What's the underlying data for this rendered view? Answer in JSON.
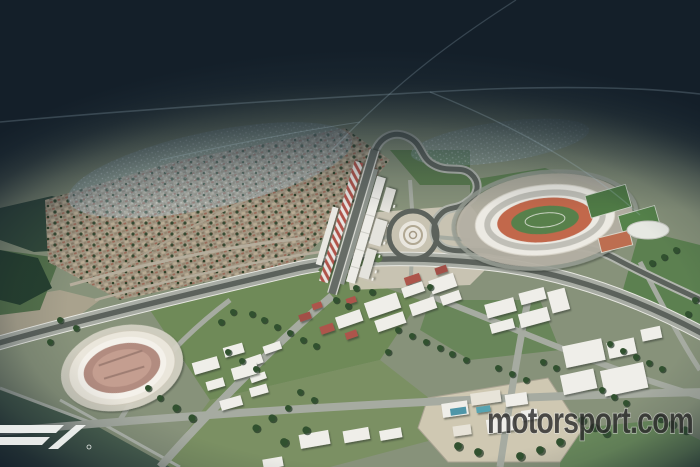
{
  "meta": {
    "description": "Aerial 3D rendering of the Hanoi Formula 1 street circuit at dusk: an illuminated circuit area with pit straight, roundabout plaza and national stadium, surrounded by a town, fields and warehouses, fading into dark fog toward the horizon."
  },
  "watermarks": {
    "motorsport": "motorsport.com",
    "f1_logo_name": "f1-logo"
  },
  "palette": {
    "fog_dark": "#16222c",
    "ground": "#87927a",
    "field_green": "#6f8a58",
    "road_light": "#a8aca4",
    "track_dark": "#5c625c",
    "building_white": "#efeee9",
    "roof_red": "#ad544b",
    "grandstand_red": "#b0524a",
    "stadium_track_orange": "#c2684c",
    "stadium_infield_green": "#58804b",
    "pool_blue": "#4f96a8",
    "lake_green": "#30483a",
    "shimmer_blue": "#9fb6c6"
  },
  "scene": {
    "labels": [
      "night-fog horizon",
      "residential town",
      "lake",
      "pit straight and paddock",
      "red-white grandstand",
      "roundabout plaza",
      "national stadium",
      "sports pitches",
      "aquatic dome",
      "warehouse district",
      "swimming-pool compound",
      "small oval arena",
      "sweeping highway",
      "race track"
    ],
    "trees": [
      [
        252,
        314
      ],
      [
        264,
        320
      ],
      [
        277,
        327
      ],
      [
        290,
        333
      ],
      [
        303,
        340
      ],
      [
        316,
        346
      ],
      [
        228,
        352
      ],
      [
        242,
        361
      ],
      [
        256,
        369
      ],
      [
        233,
        312
      ],
      [
        221,
        322
      ],
      [
        336,
        300
      ],
      [
        348,
        306
      ],
      [
        300,
        392
      ],
      [
        314,
        400
      ],
      [
        288,
        408
      ],
      [
        272,
        418,
        1.2
      ],
      [
        256,
        428,
        1.2
      ],
      [
        398,
        330
      ],
      [
        412,
        336
      ],
      [
        426,
        342
      ],
      [
        440,
        348
      ],
      [
        388,
        352
      ],
      [
        452,
        354
      ],
      [
        466,
        360
      ],
      [
        498,
        368
      ],
      [
        512,
        374
      ],
      [
        526,
        380
      ],
      [
        543,
        362
      ],
      [
        556,
        368
      ],
      [
        610,
        344
      ],
      [
        623,
        351
      ],
      [
        636,
        357
      ],
      [
        649,
        363
      ],
      [
        662,
        369
      ],
      [
        602,
        390
      ],
      [
        614,
        397
      ],
      [
        626,
        403
      ],
      [
        582,
        420,
        1.2
      ],
      [
        594,
        427,
        1.2
      ],
      [
        606,
        433,
        1.2
      ],
      [
        660,
        418,
        1.2
      ],
      [
        672,
        424,
        1.2
      ],
      [
        685,
        430,
        1.2
      ],
      [
        560,
        442,
        1.3
      ],
      [
        540,
        450,
        1.3
      ],
      [
        520,
        456,
        1.3
      ],
      [
        478,
        452,
        1.3
      ],
      [
        458,
        446,
        1.3
      ],
      [
        430,
        287
      ],
      [
        372,
        292
      ],
      [
        356,
        288
      ],
      [
        676,
        250
      ],
      [
        664,
        257
      ],
      [
        652,
        263
      ],
      [
        160,
        398
      ],
      [
        176,
        408,
        1.2
      ],
      [
        192,
        418,
        1.2
      ],
      [
        148,
        388
      ],
      [
        60,
        320
      ],
      [
        76,
        328
      ],
      [
        50,
        342
      ],
      [
        695,
        300
      ],
      [
        688,
        314
      ],
      [
        306,
        430,
        1.2
      ],
      [
        284,
        442,
        1.3
      ]
    ]
  }
}
